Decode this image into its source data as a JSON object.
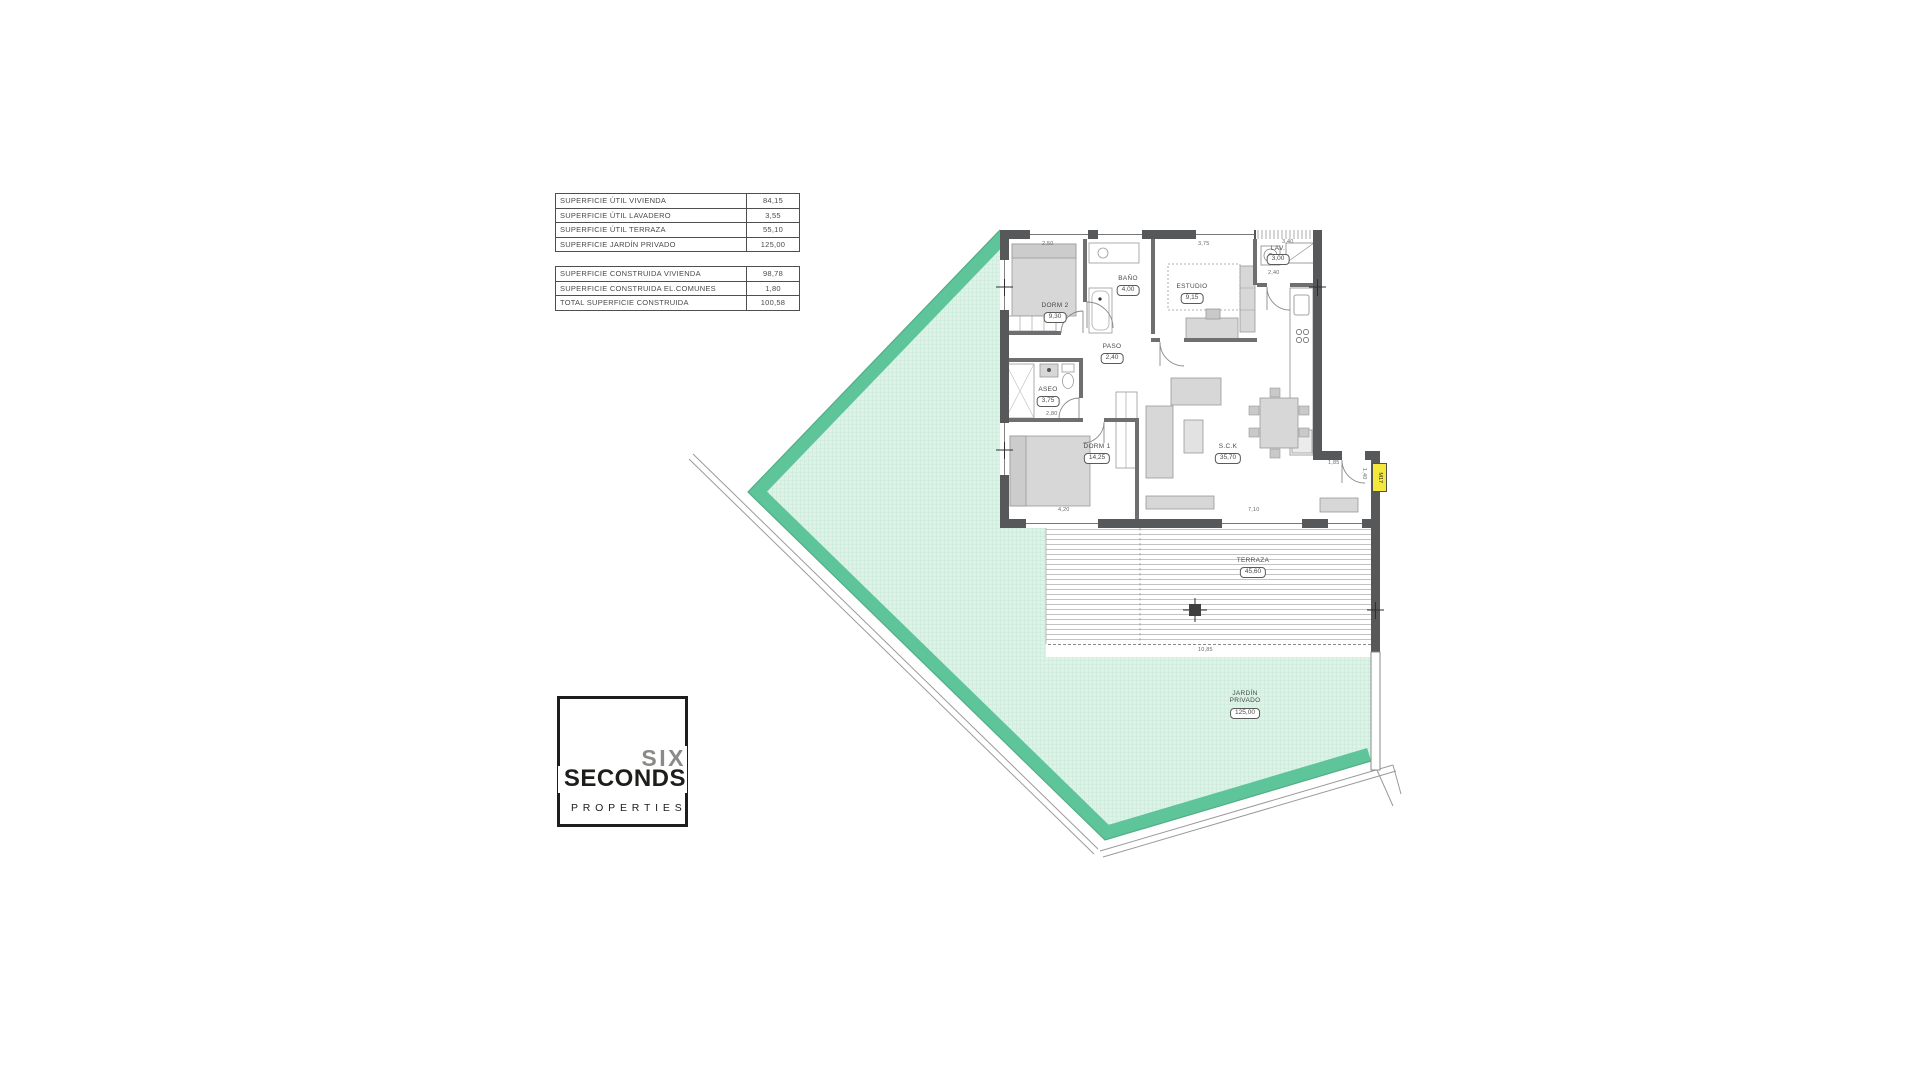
{
  "surface_tables": {
    "util": [
      {
        "label": "SUPERFICIE ÚTIL VIVIENDA",
        "value": "84,15"
      },
      {
        "label": "SUPERFICIE ÚTIL LAVADERO",
        "value": "3,55"
      },
      {
        "label": "SUPERFICIE ÚTIL TERRAZA",
        "value": "55,10"
      },
      {
        "label": "SUPERFICIE JARDÍN PRIVADO",
        "value": "125,00"
      }
    ],
    "construida": [
      {
        "label": "SUPERFICIE CONSTRUIDA VIVIENDA",
        "value": "98,78"
      },
      {
        "label": "SUPERFICIE CONSTRUIDA EL.COMUNES",
        "value": "1,80"
      },
      {
        "label": "TOTAL SUPERFICIE CONSTRUIDA",
        "value": "100,58"
      }
    ]
  },
  "logo": {
    "word1": "SIX",
    "word2": "SECONDS",
    "word3": "PROPERTIES"
  },
  "plan": {
    "rooms": [
      {
        "id": "dorm2",
        "name": "DORM 2",
        "area": "9,30"
      },
      {
        "id": "bano",
        "name": "BAÑO",
        "area": "4,00"
      },
      {
        "id": "estudio",
        "name": "ESTUDIO",
        "area": "9,15"
      },
      {
        "id": "lav",
        "name": "LAV.",
        "area": "3,00"
      },
      {
        "id": "paso",
        "name": "PASO",
        "area": "2,40"
      },
      {
        "id": "aseo",
        "name": "ASEO",
        "area": "3,75"
      },
      {
        "id": "dorm1",
        "name": "DORM 1",
        "area": "14,25"
      },
      {
        "id": "sck",
        "name": "S.C.K",
        "area": "35,70"
      },
      {
        "id": "terraza",
        "name": "TERRAZA",
        "area": "45,60"
      },
      {
        "id": "jardin",
        "name": "JARDÍN PRIVADO",
        "area": "125,00"
      }
    ],
    "dimensions": [
      "2,50",
      "3,75",
      "3,40",
      "2,40",
      "2,80",
      "4,20",
      "7,10",
      "10,85",
      "1,85",
      "1,40"
    ],
    "door_badge": "M17",
    "colors": {
      "garden_band": "#5ec49a",
      "garden_fill": "#def2e7",
      "garden_grid": "#b9e2ce",
      "wall": "#57585a",
      "badge": "#f4e83c"
    }
  }
}
